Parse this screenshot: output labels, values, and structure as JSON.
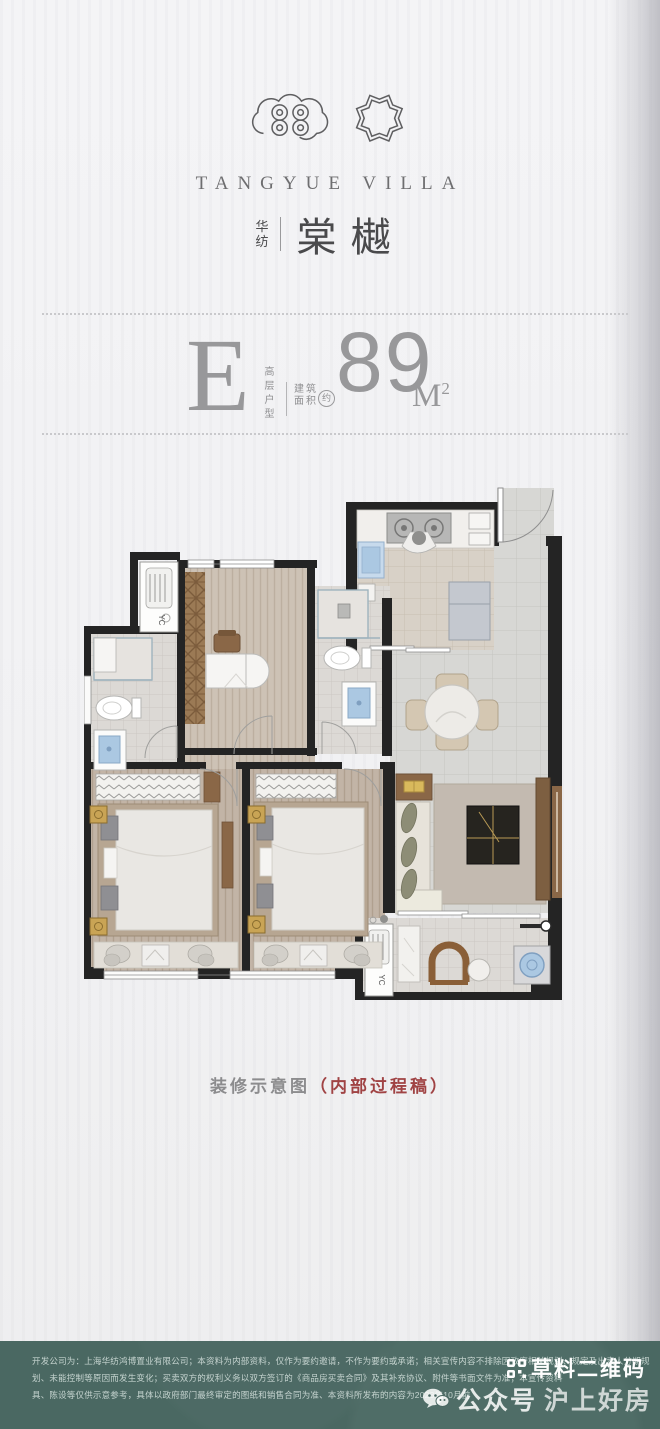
{
  "brand": {
    "name_en": "TANGYUE VILLA",
    "name_cn_prefix_1": "华",
    "name_cn_prefix_2": "纺",
    "name_cn_main": "棠樾"
  },
  "unit": {
    "letter": "E",
    "type_label": "高层户型",
    "area_label_line1": "建筑",
    "area_label_line2": "面积",
    "approx_label": "约",
    "area_value": "89",
    "area_unit": "M",
    "area_unit_sup": "2"
  },
  "floorplan": {
    "ac_label_top": "YC",
    "ac_label_balcony": "YC"
  },
  "caption": {
    "gray_part": "装修示意图",
    "red_part": "（内部过程稿）"
  },
  "footer": {
    "line1": "开发公司为：上海华纺鸿博置业有限公司；本资料为内部资料，仅作为要约邀请，不作为要约或承诺；相关宣传内容不排除因政府相关规划、规定及出卖人分期规",
    "line2": "划、未能控制等原因而发生变化；买卖双方的权利义务以双方签订的《商品房买卖合同》及其补充协议、附件等书面文件为准；本宣传资料",
    "line3": "具、陈设等仅供示意参考，具体以政府部门最终审定的图纸和销售合同为准、本资料所发布的内容为2023年10月前",
    "watermark_qr": "草料二维码",
    "watermark_account": "公众号",
    "watermark_name": "沪上好房"
  },
  "colors": {
    "footer_bg": "#4a6862",
    "caption_red": "#a04344",
    "wall": "#242424",
    "gold_accent": "#c9a455",
    "fixture_blue": "#aac9e4"
  }
}
